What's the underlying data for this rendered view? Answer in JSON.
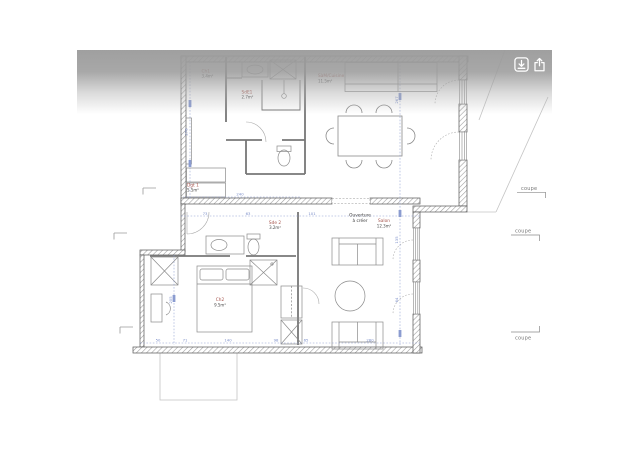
{
  "colors": {
    "accent_blue": "#8b9cd0",
    "label_red": "#a5534b",
    "wall_gray": "#555555",
    "line_gray": "#8a8a8a",
    "overlay_gray": "#9c9c9c"
  },
  "toolbar": {
    "icons": [
      {
        "name": "save-image-icon"
      },
      {
        "name": "share-icon"
      }
    ]
  },
  "plan": {
    "rooms": [
      {
        "label": "Ch1",
        "area": "3.4m²"
      },
      {
        "label": "SdE1",
        "area": "2.7m²"
      },
      {
        "label": "SàM/Cuisine",
        "area": "11.5m²"
      },
      {
        "label": "Dgt 1",
        "area": "5.5m²"
      },
      {
        "label": "Sde 2",
        "area": "3.2m²"
      },
      {
        "label": "Salon",
        "area": "12.3m²"
      },
      {
        "label": "Ch2",
        "area": "9.5m²"
      }
    ],
    "annotations": {
      "ouverture_line1": "Ouverture",
      "ouverture_line2": "à créer",
      "coupe": "coupe"
    },
    "dimensions": {
      "bottom": [
        "50",
        "71",
        "140",
        "98",
        "65",
        "280"
      ],
      "mid": [
        "73",
        "63",
        "101"
      ],
      "mid_upper": "240",
      "left_vertical": "278",
      "lower_left_vertical": "205",
      "right_vertical": [
        "267",
        "135",
        "64"
      ]
    }
  }
}
